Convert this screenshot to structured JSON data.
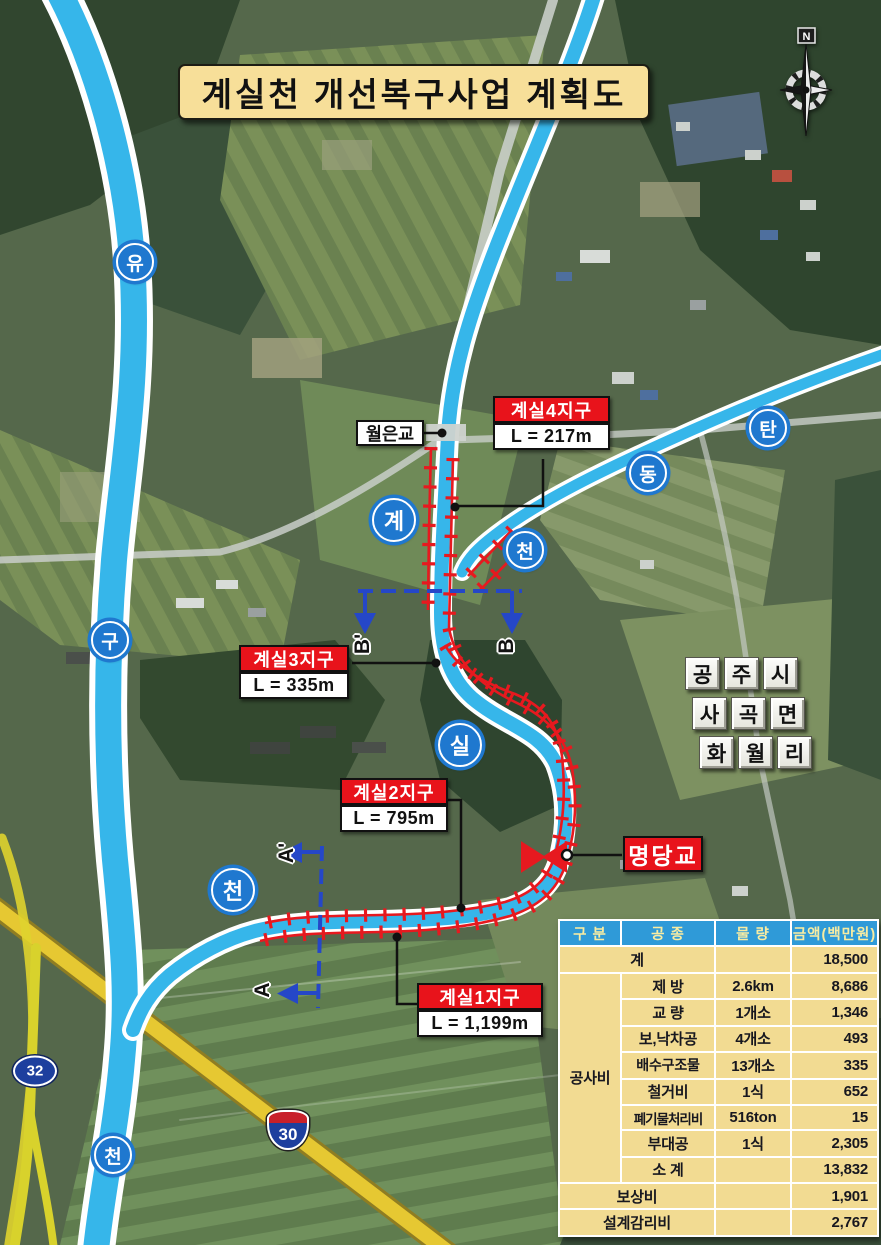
{
  "title": {
    "text": "계실천 개선복구사업 계획도"
  },
  "compass": {
    "north_label": "N"
  },
  "map_labels": {
    "wolleun_bridge": "월은교",
    "myeongdang_bridge": "명당교",
    "admin_tiles": {
      "row1": [
        "공",
        "주",
        "시"
      ],
      "row2": [
        "사",
        "곡",
        "면"
      ],
      "row3": [
        "화",
        "월",
        "리"
      ]
    }
  },
  "districts": [
    {
      "name": "계실4지구",
      "length": "L = 217m"
    },
    {
      "name": "계실3지구",
      "length": "L = 335m"
    },
    {
      "name": "계실2지구",
      "length": "L = 795m"
    },
    {
      "name": "계실1지구",
      "length": "L = 1,199m"
    }
  ],
  "stream_markers": {
    "yugu_stream": [
      "유",
      "구",
      "천"
    ],
    "gyesil_stream": [
      "계",
      "실",
      "천"
    ],
    "tandong_stream": [
      "탄",
      "동",
      "천"
    ]
  },
  "section_markers": {
    "a": "A",
    "a_prime": "A'",
    "b": "B",
    "b_prime": "B'"
  },
  "road_shields": {
    "national_route": "32",
    "expressway": "30"
  },
  "cost_table": {
    "headers": {
      "category": "구 분",
      "work_type": "공 종",
      "quantity": "물 량",
      "amount": "금액(백만원)"
    },
    "total": {
      "label": "계",
      "quantity": "",
      "amount": "18,500"
    },
    "construction_group_label": "공사비",
    "construction_rows": [
      {
        "item": "제 방",
        "quantity": "2.6km",
        "amount": "8,686"
      },
      {
        "item": "교 량",
        "quantity": "1개소",
        "amount": "1,346"
      },
      {
        "item": "보,낙차공",
        "quantity": "4개소",
        "amount": "493"
      },
      {
        "item": "배수구조물",
        "quantity": "13개소",
        "amount": "335"
      },
      {
        "item": "철거비",
        "quantity": "1식",
        "amount": "652"
      },
      {
        "item": "폐기물처리비",
        "quantity": "516ton",
        "amount": "15"
      },
      {
        "item": "부대공",
        "quantity": "1식",
        "amount": "2,305"
      },
      {
        "item": "소 계",
        "quantity": "",
        "amount": "13,832"
      }
    ],
    "footer_rows": [
      {
        "label": "보상비",
        "amount": "1,901"
      },
      {
        "label": "설계감리비",
        "amount": "2,767"
      }
    ]
  },
  "colors": {
    "title_bg": "#f7df99",
    "district_label_bg": "#e8131b",
    "stream_blue": "#36b6ea",
    "work_line_red": "#e7191f",
    "section_line_blue": "#2547c8",
    "table_header_bg": "#2f9ad8",
    "table_cell_bg": "#f2db92",
    "expressway_yellow": "#e6c832"
  }
}
